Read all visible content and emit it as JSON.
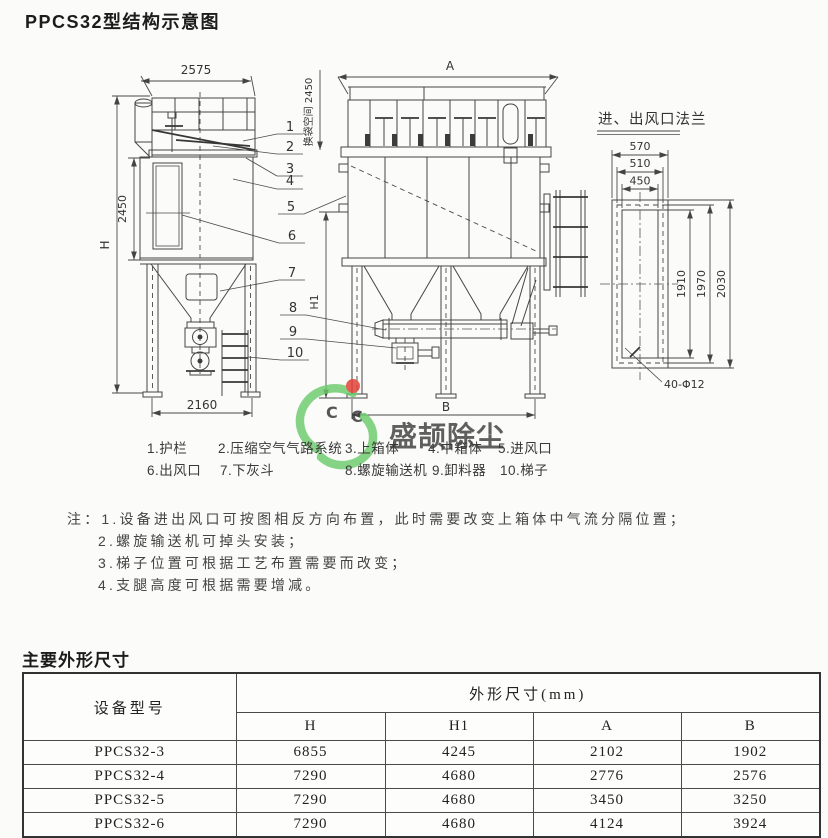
{
  "page": {
    "title": "PPCS32型结构示意图",
    "section_dims_title": "主要外形尺寸"
  },
  "diagram": {
    "side_view": {
      "dim_width_top": "2575",
      "dim_height_overall": "H",
      "dim_body_height": "2450",
      "dim_base_width": "2160"
    },
    "front_view": {
      "dim_width_top": "A",
      "bag_change_space": "换袋空间 2450",
      "dim_height_h1": "H1",
      "dim_base_width": "B"
    },
    "flange": {
      "title": "进、出风口法兰",
      "dim_w_outer": "570",
      "dim_w_mid": "510",
      "dim_w_inner": "450",
      "dim_h_inner": "1910",
      "dim_h_mid": "1970",
      "dim_h_outer": "2030",
      "holes": "40-Φ12"
    },
    "callouts": [
      "1",
      "2",
      "3",
      "4",
      "5",
      "6",
      "7",
      "8",
      "9",
      "10"
    ]
  },
  "legend": {
    "items_row1": [
      "1.护栏",
      "2.压缩空气气路系统",
      "3.上箱体",
      "4.中箱体",
      "5.进风口"
    ],
    "items_row2": [
      "6.出风口",
      "7.下灰斗",
      "8.螺旋输送机",
      "9.卸料器",
      "10.梯子"
    ]
  },
  "notes": {
    "label": "注：",
    "items": [
      "1.设备进出风口可按图相反方向布置，此时需要改变上箱体中气流分隔位置；",
      "2.螺旋输送机可掉头安装；",
      "3.梯子位置可根据工艺布置需要而改变；",
      "4.支腿高度可根据需要增减。"
    ]
  },
  "watermark": {
    "brand": "盛颉除尘",
    "mark1": "C",
    "mark2": "C",
    "color": "#92d0c5"
  },
  "table": {
    "col_model": "设备型号",
    "group_header": "外形尺寸(mm)",
    "columns": [
      "H",
      "H1",
      "A",
      "B"
    ],
    "rows": [
      {
        "model": "PPCS32-3",
        "H": "6855",
        "H1": "4245",
        "A": "2102",
        "B": "1902"
      },
      {
        "model": "PPCS32-4",
        "H": "7290",
        "H1": "4680",
        "A": "2776",
        "B": "2576"
      },
      {
        "model": "PPCS32-5",
        "H": "7290",
        "H1": "4680",
        "A": "3450",
        "B": "3250"
      },
      {
        "model": "PPCS32-6",
        "H": "7290",
        "H1": "4680",
        "A": "4124",
        "B": "3924"
      }
    ]
  }
}
